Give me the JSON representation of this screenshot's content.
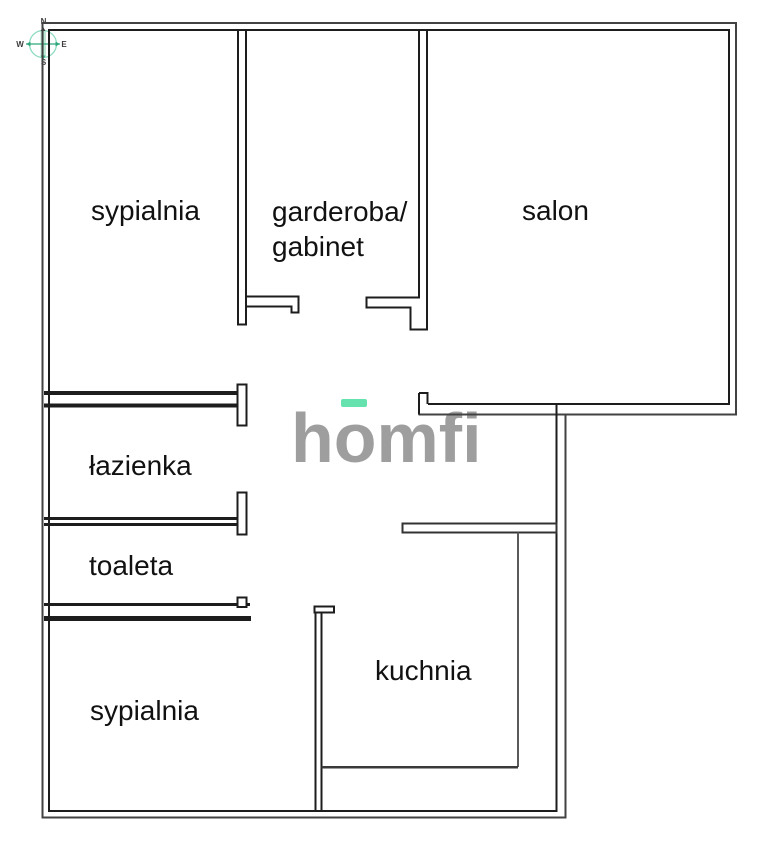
{
  "plan": {
    "title": "floor plan",
    "rooms": [
      {
        "id": "sypialnia-1",
        "label": "sypialnia",
        "left": 91,
        "top": 197
      },
      {
        "id": "garderoba-gabinet-line1",
        "label": "garderoba/",
        "left": 272,
        "top": 198
      },
      {
        "id": "garderoba-gabinet-line2",
        "label": "gabinet",
        "left": 272,
        "top": 233
      },
      {
        "id": "salon",
        "label": "salon",
        "left": 522,
        "top": 197
      },
      {
        "id": "lazienka",
        "label": "łazienka",
        "left": 89,
        "top": 452
      },
      {
        "id": "toaleta",
        "label": "toaleta",
        "left": 89,
        "top": 552
      },
      {
        "id": "kuchnia",
        "label": "kuchnia",
        "left": 375,
        "top": 657
      },
      {
        "id": "sypialnia-2",
        "label": "sypialnia",
        "left": 90,
        "top": 697
      }
    ]
  },
  "watermark": {
    "brand": "homfi",
    "part_before_o": "h",
    "letter_o": "o",
    "part_after_o": "mfi"
  },
  "compass": {
    "n": "N",
    "e": "E",
    "s": "S",
    "w": "W"
  },
  "colors": {
    "wall": "#1d1d1d",
    "wall-outer": "#424242",
    "wall-light": "#5a5a5a",
    "brand-green": "#66e2af",
    "logo-gray": "#9e9e9e",
    "compass-green": "#2ea77c",
    "compass-circle": "#8edcc0",
    "compass-needle": "#bde8d5",
    "label-text": "#111111"
  }
}
